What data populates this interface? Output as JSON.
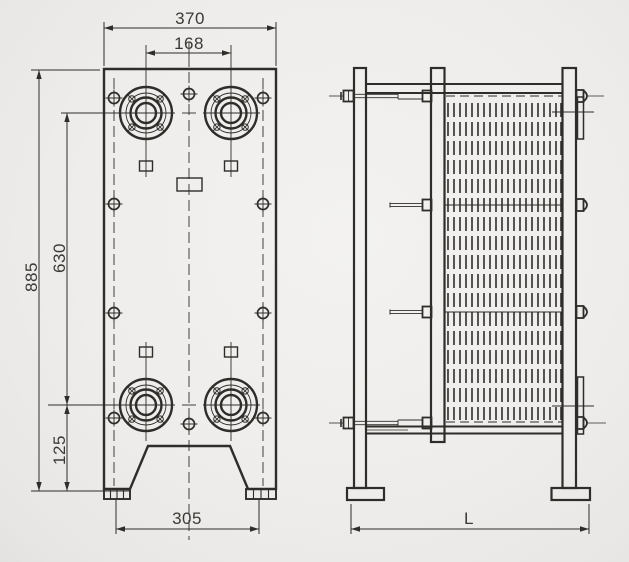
{
  "front_view": {
    "dimensions": {
      "overall_width": "370",
      "port_spacing_horizontal": "168",
      "overall_height": "885",
      "port_spacing_vertical": "630",
      "port_center_to_base": "125",
      "feet_spacing": "305"
    }
  },
  "side_view": {
    "dimensions": {
      "overall_length": "L"
    }
  },
  "colors": {
    "line": "#2f2d2a",
    "thin_line": "#47443f",
    "text": "#3b3935",
    "background": "#efedeb"
  }
}
